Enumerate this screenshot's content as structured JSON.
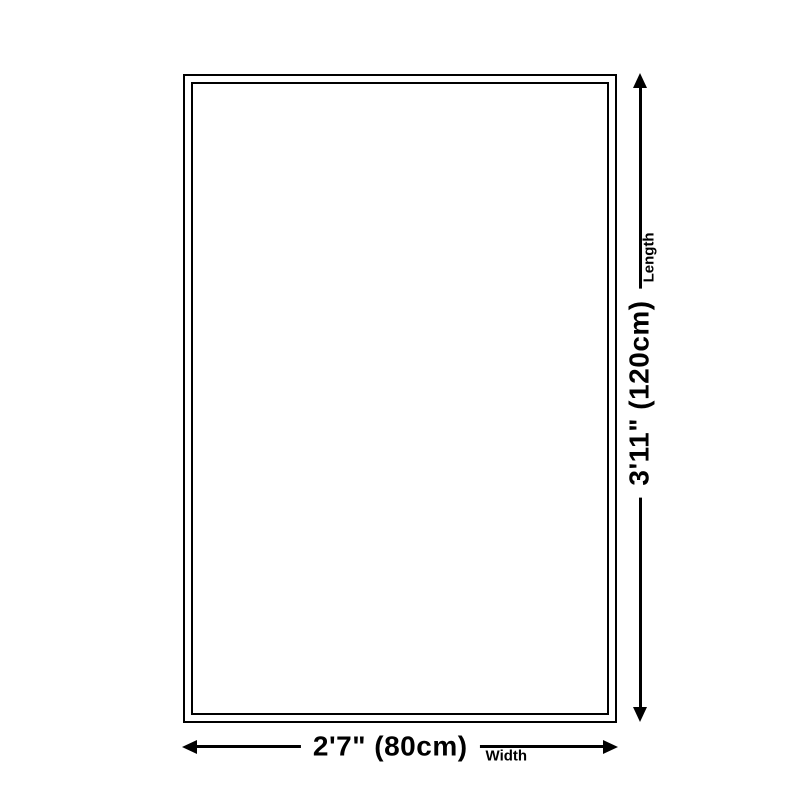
{
  "diagram": {
    "background_color": "#ffffff",
    "line_color": "#000000",
    "length": {
      "value": "3'11\" (120cm)",
      "label": "Length"
    },
    "width": {
      "value": "2'7\" (80cm)",
      "label": "Width"
    }
  }
}
